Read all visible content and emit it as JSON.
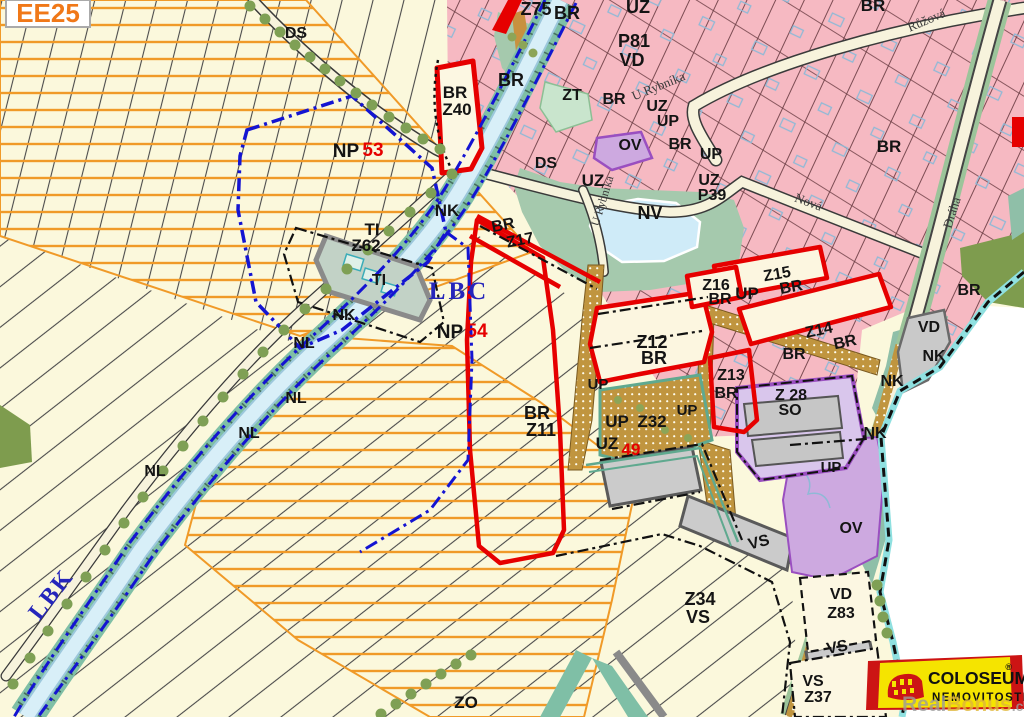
{
  "map": {
    "corner_label": {
      "text": "EE25",
      "color": "#F07818"
    },
    "labels": [
      {
        "text": "DS",
        "x": 296,
        "y": 38
      },
      {
        "text": "Z75",
        "x": 536,
        "y": 15,
        "size": 18
      },
      {
        "text": "BR",
        "x": 567,
        "y": 19,
        "size": 18
      },
      {
        "text": "UZ",
        "x": 638,
        "y": 13,
        "size": 18
      },
      {
        "text": "P81",
        "x": 634,
        "y": 47,
        "size": 18
      },
      {
        "text": "VD",
        "x": 632,
        "y": 66,
        "size": 18
      },
      {
        "text": "U Rybníka",
        "x": 660,
        "y": 90,
        "size": 13,
        "rot": -22,
        "font": "serif",
        "color": "#3A3A3A"
      },
      {
        "text": "ZT",
        "x": 572,
        "y": 100
      },
      {
        "text": "BR",
        "x": 614,
        "y": 104
      },
      {
        "text": "UZ",
        "x": 657,
        "y": 111
      },
      {
        "text": "UP",
        "x": 668,
        "y": 126
      },
      {
        "text": "BR",
        "x": 680,
        "y": 149
      },
      {
        "text": "UP",
        "x": 711,
        "y": 159
      },
      {
        "text": "UZ",
        "x": 709,
        "y": 185
      },
      {
        "text": "P39",
        "x": 712,
        "y": 200
      },
      {
        "text": "BR",
        "x": 873,
        "y": 11,
        "size": 17
      },
      {
        "text": "Růžová",
        "x": 928,
        "y": 24,
        "size": 13,
        "rot": -23,
        "font": "serif",
        "color": "#3A3A3A"
      },
      {
        "text": "BR",
        "x": 889,
        "y": 152,
        "size": 17
      },
      {
        "text": "Nová",
        "x": 807,
        "y": 206,
        "size": 13,
        "rot": 20,
        "font": "serif",
        "color": "#3A3A3A"
      },
      {
        "text": "Dráha",
        "x": 956,
        "y": 214,
        "size": 13,
        "rot": -72,
        "font": "serif",
        "color": "#3A3A3A"
      },
      {
        "text": "BR",
        "x": 969,
        "y": 295
      },
      {
        "text": "BR",
        "x": 455,
        "y": 98,
        "size": 17
      },
      {
        "text": "Z40",
        "x": 457,
        "y": 115,
        "size": 17
      },
      {
        "text": "BR",
        "x": 511,
        "y": 86,
        "size": 18
      },
      {
        "text": "DS",
        "x": 546,
        "y": 168
      },
      {
        "text": "UZ",
        "x": 593,
        "y": 186,
        "size": 17
      },
      {
        "text": "OV",
        "x": 630,
        "y": 150
      },
      {
        "text": "NV",
        "x": 650,
        "y": 219,
        "size": 18
      },
      {
        "text": "U Rybníka",
        "x": 606,
        "y": 202,
        "size": 12,
        "rot": -73,
        "font": "serif",
        "color": "#3A3A3A"
      },
      {
        "text": "NP",
        "x": 346,
        "y": 157,
        "size": 19
      },
      {
        "text": "53",
        "x": 373,
        "y": 156,
        "size": 19,
        "color": "#E60000"
      },
      {
        "text": "TI",
        "x": 372,
        "y": 235,
        "size": 17
      },
      {
        "text": "Z62",
        "x": 366,
        "y": 251,
        "size": 17
      },
      {
        "text": "TI",
        "x": 379,
        "y": 285
      },
      {
        "text": "NK",
        "x": 447,
        "y": 216,
        "size": 17
      },
      {
        "text": "BR",
        "x": 504,
        "y": 230,
        "rot": -11
      },
      {
        "text": "Z17",
        "x": 521,
        "y": 245,
        "rot": -11
      },
      {
        "text": "LBC",
        "x": 459,
        "y": 299,
        "size": 25,
        "color": "#2525BB",
        "font": "serif",
        "bold": true,
        "ls": 3
      },
      {
        "text": "NP",
        "x": 450,
        "y": 338,
        "size": 19
      },
      {
        "text": "54",
        "x": 477,
        "y": 337,
        "size": 19,
        "color": "#E60000"
      },
      {
        "text": "NK",
        "x": 344,
        "y": 320
      },
      {
        "text": "NL",
        "x": 304,
        "y": 348
      },
      {
        "text": "NL",
        "x": 296,
        "y": 403
      },
      {
        "text": "NL",
        "x": 249,
        "y": 438
      },
      {
        "text": "NL",
        "x": 155,
        "y": 476
      },
      {
        "text": "LBK",
        "x": 57,
        "y": 599,
        "size": 24,
        "color": "#2525BB",
        "font": "serif",
        "bold": true,
        "rot": -52,
        "ls": 2
      },
      {
        "text": "BR",
        "x": 537,
        "y": 419,
        "size": 18
      },
      {
        "text": "Z11",
        "x": 541,
        "y": 436,
        "size": 18
      },
      {
        "text": "Z12",
        "x": 652,
        "y": 348,
        "size": 18
      },
      {
        "text": "BR",
        "x": 654,
        "y": 364,
        "size": 18
      },
      {
        "text": "UP",
        "x": 598,
        "y": 389,
        "size": 15
      },
      {
        "text": "UP",
        "x": 687,
        "y": 415,
        "size": 15
      },
      {
        "text": "UP",
        "x": 617,
        "y": 427,
        "size": 17
      },
      {
        "text": "Z32",
        "x": 652,
        "y": 427,
        "size": 17
      },
      {
        "text": "UZ",
        "x": 607,
        "y": 449,
        "size": 17
      },
      {
        "text": "49",
        "x": 631,
        "y": 455,
        "size": 17,
        "color": "#E60000"
      },
      {
        "text": "Z16",
        "x": 716,
        "y": 290
      },
      {
        "text": "BR",
        "x": 720,
        "y": 304
      },
      {
        "text": "UP",
        "x": 747,
        "y": 299,
        "size": 17
      },
      {
        "text": "Z15",
        "x": 778,
        "y": 279,
        "rot": -10
      },
      {
        "text": "BR",
        "x": 792,
        "y": 292,
        "rot": -10
      },
      {
        "text": "Z14",
        "x": 820,
        "y": 335,
        "rot": -12
      },
      {
        "text": "BR",
        "x": 846,
        "y": 347,
        "rot": -12
      },
      {
        "text": "BR",
        "x": 794,
        "y": 359
      },
      {
        "text": "Z13",
        "x": 731,
        "y": 380
      },
      {
        "text": "BR",
        "x": 726,
        "y": 398
      },
      {
        "text": "Z 28",
        "x": 791,
        "y": 400
      },
      {
        "text": "SO",
        "x": 790,
        "y": 415
      },
      {
        "text": "VD",
        "x": 929,
        "y": 332
      },
      {
        "text": "NK",
        "x": 934,
        "y": 361
      },
      {
        "text": "NK",
        "x": 892,
        "y": 386
      },
      {
        "text": "NK",
        "x": 875,
        "y": 438
      },
      {
        "text": "UP",
        "x": 831,
        "y": 472,
        "size": 15
      },
      {
        "text": "OV",
        "x": 851,
        "y": 533
      },
      {
        "text": "VS",
        "x": 760,
        "y": 547,
        "rot": -14
      },
      {
        "text": "Z34",
        "x": 700,
        "y": 605,
        "size": 18
      },
      {
        "text": "VS",
        "x": 698,
        "y": 623,
        "size": 18
      },
      {
        "text": "VD",
        "x": 841,
        "y": 599
      },
      {
        "text": "Z83",
        "x": 841,
        "y": 618
      },
      {
        "text": "VS",
        "x": 838,
        "y": 652,
        "rot": -10
      },
      {
        "text": "VS",
        "x": 813,
        "y": 686
      },
      {
        "text": "Z37",
        "x": 818,
        "y": 702
      },
      {
        "text": "ZO",
        "x": 466,
        "y": 708,
        "size": 17
      }
    ],
    "palette": {
      "background": "#FBF8DC",
      "residential_pink": "#F6B9C2",
      "orange_hatch": "#F09A28",
      "green_public": "#A5C9AD",
      "corridor_teal": "#7FBFA6",
      "water": "#CFEBF8",
      "eco_blue": "#1414D2",
      "zone_red": "#E60000",
      "path_tan": "#C0953F",
      "civic_purple": "#CDA9E0",
      "industry_gray": "#C9C9C9",
      "olive_green": "#7E9C4E",
      "boundary_cyan": "#8FE0E0",
      "logo_yellow": "#F5E400",
      "logo_red": "#CC1414"
    }
  },
  "logo": {
    "brand": "COLOSEUM",
    "registered": "®",
    "subtitle": "NEMOVITOSTI"
  },
  "watermark": {
    "part1": "Real",
    "part2": "Bonus",
    "part3": ".cz"
  }
}
